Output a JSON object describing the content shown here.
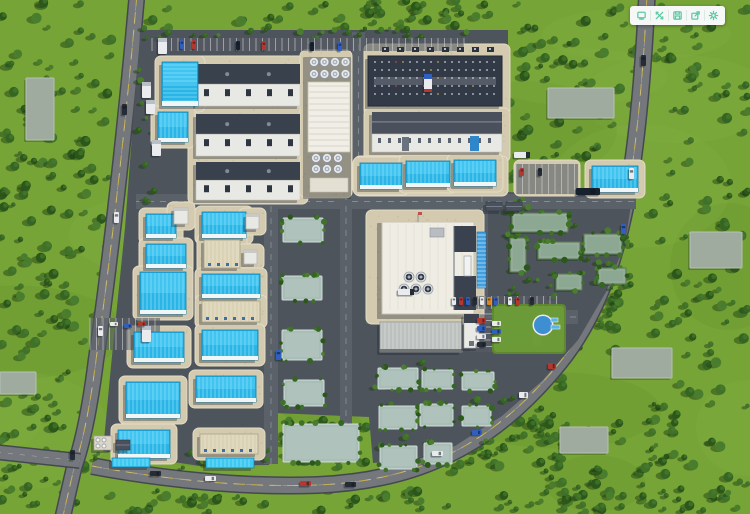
{
  "app": {
    "view_label": "3d-industrial-park-aerial-view"
  },
  "toolbar": {
    "background": "#f6f8f7",
    "icon_color": "#5fc9a6",
    "buttons": [
      {
        "name": "screen-icon"
      },
      {
        "name": "expand-icon"
      },
      {
        "name": "save-icon"
      },
      {
        "name": "export-icon"
      },
      {
        "name": "settings-icon"
      }
    ]
  },
  "scene": {
    "type": "3d-aerial-industrial-park",
    "colors": {
      "grass": "#76a437",
      "grass_light": "#86b246",
      "grass_dark": "#5f8d2c",
      "tree_palette": [
        "#2c571b",
        "#356523",
        "#3f7128",
        "#4a7d2e"
      ],
      "tree_shadow": "#1d3a10",
      "road": "#74787d",
      "road_edge": "#45494f",
      "road_yellow": "#d2b545",
      "road_white": "#d7dadd",
      "campus": "#4e545c",
      "inner_road": "#5b6169",
      "apron": "#d3cab0",
      "apron_edge": "#e4dcc6",
      "cyan_roof": "#2ab5e6",
      "cyan_light": "#55d0f8",
      "cyan_rib": "#8fe4fb",
      "cyan_edge": "#0f7fae",
      "cream": "#e0d8bf",
      "white_bldg": "#e8e8e5",
      "dark_bldg": "#323a47",
      "roof_gray": "#39414d",
      "teal_pad": "#b0c2bc",
      "slab": "#9fab9f",
      "green_roof": "#8ca893",
      "plant_body": "#efece3",
      "pond": "#3e8ed2",
      "car_white": "#e9ebee",
      "car_red": "#b5372f",
      "car_blue": "#2f5fc0",
      "car_dark": "#262c35",
      "car_navy": "#18212e",
      "car_orange": "#d8871f"
    },
    "roads": [
      {
        "d": "M137,-6 C128,100 112,250 96,360 C90,408 82,445 74,468 L63,516",
        "w": 14,
        "center": "yellow"
      },
      {
        "d": "M647,-6 C644,60 638,140 626,204 C613,270 592,322 560,362 C526,404 488,437 441,458 C404,475 362,483 318,485 C240,488 156,478 92,466",
        "w": 15,
        "center": "yellow"
      },
      {
        "d": "M-4,452 L80,461",
        "w": 13,
        "center": "none"
      }
    ],
    "campus_polygon": "140,30 508,30 508,192 632,199 625,243 606,292 578,340 543,380 502,416 455,446 409,460 373,463 369,417 273,413 269,465 200,466 140,457 103,451 111,366 125,228 134,108 139,52",
    "inner_roads": [
      [
        136,
        194,
        500,
        15
      ],
      [
        264,
        194,
        14,
        270
      ],
      [
        340,
        194,
        12,
        262
      ],
      [
        366,
        310,
        212,
        14
      ],
      [
        476,
        196,
        12,
        116
      ],
      [
        352,
        32,
        13,
        164
      ]
    ],
    "tree_zones": [
      [
        "out",
        0,
        0,
        118,
        336,
        110,
        1
      ],
      [
        "out",
        0,
        336,
        88,
        178,
        48,
        2
      ],
      [
        "out",
        142,
        0,
        360,
        28,
        40,
        3
      ],
      [
        "out",
        510,
        0,
        132,
        190,
        70,
        4
      ],
      [
        "out",
        652,
        0,
        98,
        514,
        120,
        5
      ],
      [
        "out",
        564,
        290,
        56,
        68,
        26,
        6
      ],
      [
        "out",
        300,
        486,
        440,
        26,
        40,
        7
      ],
      [
        "out",
        88,
        488,
        212,
        24,
        18,
        8
      ],
      [
        "out",
        452,
        368,
        118,
        106,
        55,
        9
      ],
      [
        "out",
        540,
        418,
        116,
        92,
        42,
        10
      ],
      [
        "out",
        276,
        416,
        92,
        52,
        22,
        11
      ],
      [
        "camp",
        506,
        198,
        72,
        100,
        34,
        12
      ],
      [
        "camp",
        576,
        230,
        56,
        60,
        20,
        13
      ],
      [
        "camp",
        356,
        356,
        158,
        112,
        26,
        14
      ],
      [
        "camp",
        88,
        448,
        266,
        22,
        22,
        15
      ],
      [
        "camp",
        140,
        28,
        330,
        11,
        26,
        16
      ],
      [
        "camp",
        138,
        60,
        20,
        300,
        16,
        17
      ]
    ],
    "slabs": [
      [
        548,
        88,
        66,
        30
      ],
      [
        612,
        348,
        60,
        30
      ],
      [
        560,
        427,
        48,
        26
      ],
      [
        26,
        78,
        28,
        62
      ],
      [
        0,
        372,
        36,
        22
      ],
      [
        690,
        232,
        52,
        36
      ]
    ],
    "aprons": [
      [
        188,
        56,
        120,
        148
      ],
      [
        300,
        50,
        52,
        148
      ],
      [
        364,
        44,
        146,
        72
      ],
      [
        364,
        108,
        146,
        54
      ],
      [
        354,
        156,
        154,
        40
      ],
      [
        514,
        160,
        66,
        36
      ],
      [
        366,
        210,
        118,
        114
      ]
    ],
    "stalls": [
      [
        152,
        38,
        312,
        13,
        "v"
      ],
      [
        90,
        318,
        70,
        32,
        "v"
      ],
      [
        516,
        164,
        62,
        30,
        "v"
      ],
      [
        446,
        296,
        112,
        13,
        "v"
      ],
      [
        470,
        314,
        36,
        38,
        "h"
      ]
    ],
    "pads": [
      [
        283,
        218,
        40,
        24
      ],
      [
        282,
        276,
        40,
        24
      ],
      [
        282,
        330,
        40,
        30
      ],
      [
        284,
        380,
        40,
        26
      ],
      [
        283,
        424,
        76,
        38
      ],
      [
        378,
        368,
        40,
        21
      ],
      [
        422,
        370,
        31,
        19
      ],
      [
        462,
        372,
        32,
        18
      ],
      [
        379,
        406,
        38,
        23
      ],
      [
        420,
        404,
        33,
        22
      ],
      [
        462,
        406,
        29,
        20
      ],
      [
        380,
        446,
        37,
        23
      ],
      [
        424,
        443,
        28,
        21
      ]
    ],
    "buildings": [
      [
        "lab",
        196,
        64,
        104,
        42
      ],
      [
        "lab",
        196,
        114,
        104,
        42
      ],
      [
        "lab",
        196,
        162,
        104,
        38
      ],
      [
        "utility",
        306,
        54,
        48,
        142
      ],
      [
        "dark",
        368,
        56,
        134,
        50
      ],
      [
        "gable",
        372,
        112,
        130,
        40
      ],
      [
        "cyan",
        360,
        163,
        42,
        26
      ],
      [
        "cyan",
        406,
        161,
        44,
        26
      ],
      [
        "cyan",
        454,
        160,
        42,
        26
      ],
      [
        "cyan",
        592,
        166,
        46,
        26
      ],
      [
        "cyan",
        162,
        62,
        36,
        44
      ],
      [
        "cyan",
        158,
        112,
        30,
        30
      ],
      [
        "cyan",
        146,
        214,
        30,
        24
      ],
      [
        "box",
        174,
        208,
        14,
        16
      ],
      [
        "cyan",
        202,
        212,
        44,
        26
      ],
      [
        "box",
        246,
        214,
        13,
        15
      ],
      [
        "cyan",
        146,
        244,
        40,
        24
      ],
      [
        "cream",
        204,
        240,
        36,
        28
      ],
      [
        "box",
        244,
        250,
        13,
        14
      ],
      [
        "cyan",
        140,
        272,
        46,
        42
      ],
      [
        "cyan",
        202,
        274,
        58,
        24
      ],
      [
        "cream",
        202,
        301,
        58,
        21
      ],
      [
        "cyan",
        134,
        332,
        50,
        30
      ],
      [
        "cyan",
        202,
        330,
        56,
        30
      ],
      [
        "cyan",
        126,
        382,
        54,
        36
      ],
      [
        "cyan",
        196,
        376,
        60,
        26
      ],
      [
        "cyan",
        118,
        430,
        52,
        28
      ],
      [
        "cream",
        200,
        434,
        58,
        20
      ],
      [
        "canopy",
        112,
        458,
        38,
        9
      ],
      [
        "canopy",
        206,
        458,
        48,
        10
      ],
      [
        "plant",
        380,
        220,
        96,
        96
      ],
      [
        "panel",
        477,
        232,
        9,
        56
      ],
      [
        "rgray",
        380,
        322,
        82,
        30
      ],
      [
        "tower",
        464,
        314,
        15,
        34
      ],
      [
        "office",
        504,
        310,
        34,
        38
      ],
      [
        "green",
        512,
        213,
        56,
        19
      ],
      [
        "green",
        510,
        238,
        16,
        34
      ],
      [
        "green",
        538,
        242,
        42,
        17
      ],
      [
        "green",
        584,
        234,
        38,
        20
      ],
      [
        "green",
        556,
        274,
        26,
        16
      ],
      [
        "green",
        598,
        268,
        28,
        16
      ],
      [
        "shed",
        486,
        202,
        16,
        9
      ],
      [
        "shed",
        506,
        202,
        16,
        9
      ],
      [
        "cool",
        94,
        436,
        18,
        14
      ],
      [
        "shed",
        116,
        440,
        14,
        10
      ]
    ],
    "amenity": {
      "lawn": [
        492,
        304,
        74,
        50
      ],
      "pond": [
        543,
        325,
        9
      ],
      "slides": [
        [
          551,
          318,
          7,
          4
        ],
        [
          551,
          325,
          9,
          4
        ]
      ]
    },
    "vehicles": [
      [
        "d",
        122,
        104,
        5,
        11
      ],
      [
        "w",
        114,
        212,
        5,
        11
      ],
      [
        "w",
        98,
        326,
        5,
        10
      ],
      [
        "d",
        70,
        450,
        5,
        10
      ],
      [
        "d",
        150,
        471,
        11,
        5
      ],
      [
        "w",
        205,
        476,
        11,
        5
      ],
      [
        "r",
        300,
        481,
        11,
        5
      ],
      [
        "d",
        345,
        482,
        11,
        5
      ],
      [
        "w",
        432,
        451,
        11,
        5
      ],
      [
        "b",
        472,
        430,
        10,
        5
      ],
      [
        "w",
        519,
        392,
        9,
        6
      ],
      [
        "r",
        548,
        363,
        8,
        6
      ],
      [
        "d",
        641,
        55,
        5,
        11
      ],
      [
        "w",
        629,
        168,
        5,
        11
      ],
      [
        "b",
        621,
        224,
        5,
        10
      ],
      [
        "b",
        180,
        40,
        4,
        9
      ],
      [
        "r",
        192,
        40,
        4,
        9
      ],
      [
        "n",
        236,
        41,
        4,
        9
      ],
      [
        "r",
        262,
        41,
        4,
        9
      ],
      [
        "n",
        310,
        42,
        4,
        9
      ],
      [
        "b",
        338,
        42,
        4,
        9
      ],
      [
        "tv",
        424,
        74,
        8,
        18
      ],
      [
        "th",
        514,
        152,
        16,
        6
      ],
      [
        "th",
        398,
        289,
        16,
        6
      ],
      [
        "n",
        576,
        188,
        24,
        7
      ],
      [
        "tw",
        158,
        38,
        9,
        16
      ],
      [
        "tw",
        142,
        82,
        9,
        16
      ],
      [
        "tw",
        146,
        100,
        9,
        14
      ],
      [
        "tw",
        152,
        140,
        9,
        16
      ],
      [
        "tw",
        142,
        326,
        9,
        16
      ],
      [
        "b",
        276,
        350,
        5,
        10
      ],
      [
        "r",
        520,
        168,
        4,
        8
      ],
      [
        "d",
        538,
        168,
        4,
        8
      ],
      [
        "w",
        110,
        322,
        8,
        4
      ],
      [
        "b",
        124,
        324,
        8,
        4
      ],
      [
        "r",
        138,
        322,
        8,
        4
      ],
      [
        "w",
        452,
        297,
        4,
        8
      ],
      [
        "r",
        459,
        297,
        4,
        8
      ],
      [
        "b",
        466,
        297,
        4,
        8
      ],
      [
        "d",
        473,
        297,
        4,
        8
      ],
      [
        "w",
        480,
        297,
        4,
        8
      ],
      [
        "o",
        487,
        297,
        4,
        8
      ],
      [
        "b",
        494,
        297,
        4,
        8
      ],
      [
        "w",
        508,
        297,
        4,
        8
      ],
      [
        "r",
        516,
        297,
        4,
        8
      ],
      [
        "d",
        530,
        297,
        4,
        8
      ],
      [
        "r",
        477,
        318,
        9,
        5
      ],
      [
        "b",
        477,
        326,
        9,
        5
      ],
      [
        "w",
        477,
        334,
        9,
        5
      ],
      [
        "d",
        477,
        342,
        9,
        5
      ],
      [
        "w",
        492,
        321,
        9,
        5
      ],
      [
        "b",
        492,
        329,
        9,
        5
      ],
      [
        "w",
        492,
        337,
        9,
        5
      ]
    ]
  }
}
